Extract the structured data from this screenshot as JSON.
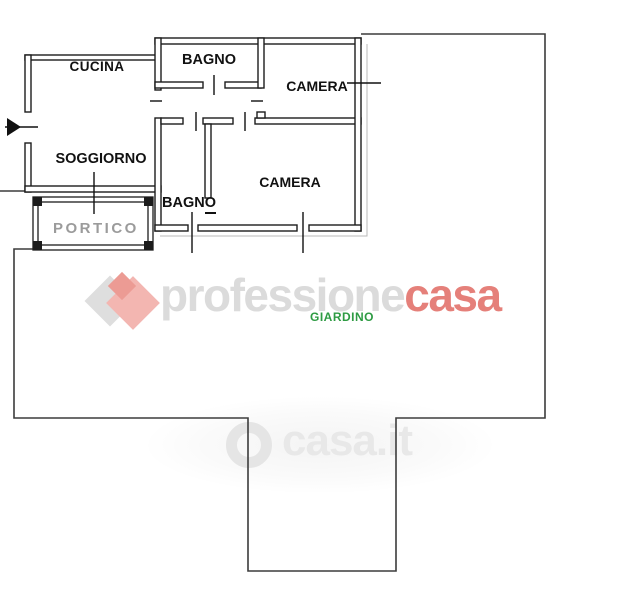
{
  "page": {
    "width": 634,
    "height": 600,
    "background": "#ffffff",
    "type": "real-estate floor plan with garden"
  },
  "floor_plan": {
    "rooms": {
      "cucina": {
        "label": "CUCINA"
      },
      "bagno_top": {
        "label": "BAGNO"
      },
      "camera_top": {
        "label": "CAMERA"
      },
      "soggiorno": {
        "label": "SOGGIORNO"
      },
      "bagno_mid": {
        "label": "BAGN",
        "label_end": "O"
      },
      "camera_mid": {
        "label": "CAMERA"
      },
      "portico": {
        "label": "PORTICO"
      },
      "giardino": {
        "label": "GIARDINO"
      }
    },
    "colors": {
      "walls": "#1c1c1c",
      "garden_boundary": "#3c3c3c",
      "room_label": "#111111",
      "portico_label": "#9b9b9b",
      "giardino_label": "#2e9b43",
      "shadow_line": "#b8b8b8"
    }
  },
  "watermarks": {
    "agency": {
      "name_gray": "professione",
      "name_red": "casa",
      "color_gray": "#dbdbdb",
      "color_red": "#e5807a",
      "diamond_gray": "#dedede",
      "diamond_pink": "#f3b6b1",
      "diamond_dark_pink": "#ec9b94"
    },
    "portal": {
      "text": "casa.it",
      "color": "#e8e8e8"
    }
  }
}
